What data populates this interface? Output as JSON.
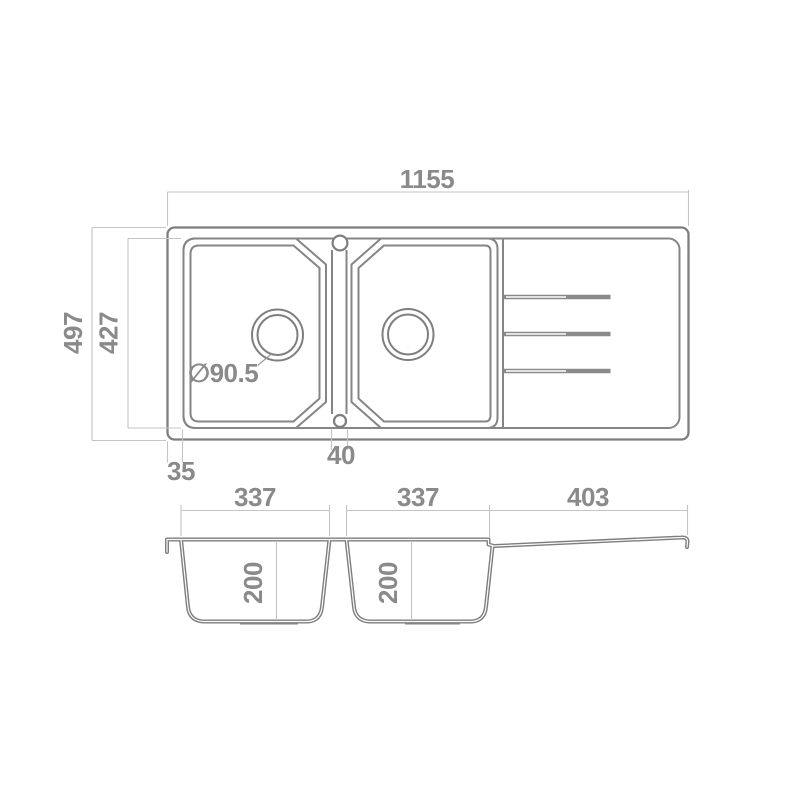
{
  "drawing": {
    "product": "double-bowl sink with drainboard",
    "plan_view": {
      "label_overall_width": "1155",
      "label_overall_depth": "497",
      "label_inner_depth": "427",
      "label_edge_offset": "35",
      "label_center_divider": "40",
      "label_drain_diameter": "∅90.5"
    },
    "section_view": {
      "label_bowl1_width": "337",
      "label_bowl2_width": "337",
      "label_drainboard_width": "403",
      "label_bowl1_depth": "200",
      "label_bowl2_depth": "200"
    },
    "colors": {
      "outline": "#7e7e7e",
      "dimension_line": "#c4c4c4",
      "label_text": "#8a8a8a",
      "background": "#ffffff"
    }
  }
}
